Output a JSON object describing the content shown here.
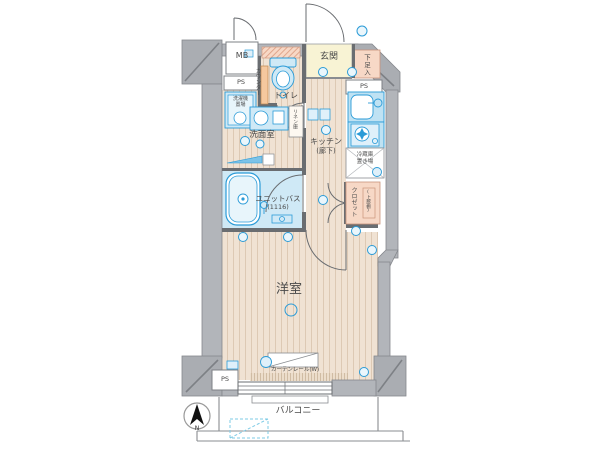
{
  "plan_type": "apartment-floor-plan",
  "colors": {
    "wall_gray": "#b2b5ba",
    "floor_beige": "#f0e2d3",
    "accent_blue": "#2b9bd7",
    "bath_blue": "#cfe9f6",
    "entrance_yellow": "#f8f3d4",
    "closet_pink": "#f7d8c6"
  },
  "rooms": {
    "meter_box": {
      "label": "MB"
    },
    "pipe_space_top_left": {
      "label": "PS"
    },
    "pipe_space_top_right": {
      "label": "PS"
    },
    "pipe_space_bottom": {
      "label": "PS"
    },
    "entrance": {
      "label": "玄関"
    },
    "shoe_box": {
      "label": "下足入"
    },
    "toilet": {
      "label": "トイレ",
      "counter": "カウンター"
    },
    "washroom": {
      "label": "洗面室",
      "washing_machine": [
        "洗濯機",
        "置場"
      ],
      "linen": "リネン庫"
    },
    "kitchen": {
      "label": "キッチン",
      "sub": "(廊下)",
      "fridge": [
        "冷蔵庫",
        "置き場"
      ]
    },
    "closet": {
      "label": "クロゼット",
      "shelf": "(上部棚)"
    },
    "unit_bath": {
      "label": "ユニットバス",
      "size": "(1116)"
    },
    "main_room": {
      "label": "洋室",
      "curtain_rail": "カーテンレール(W)"
    },
    "balcony": {
      "label": "バルコニー"
    },
    "compass": {
      "label": "N"
    }
  }
}
